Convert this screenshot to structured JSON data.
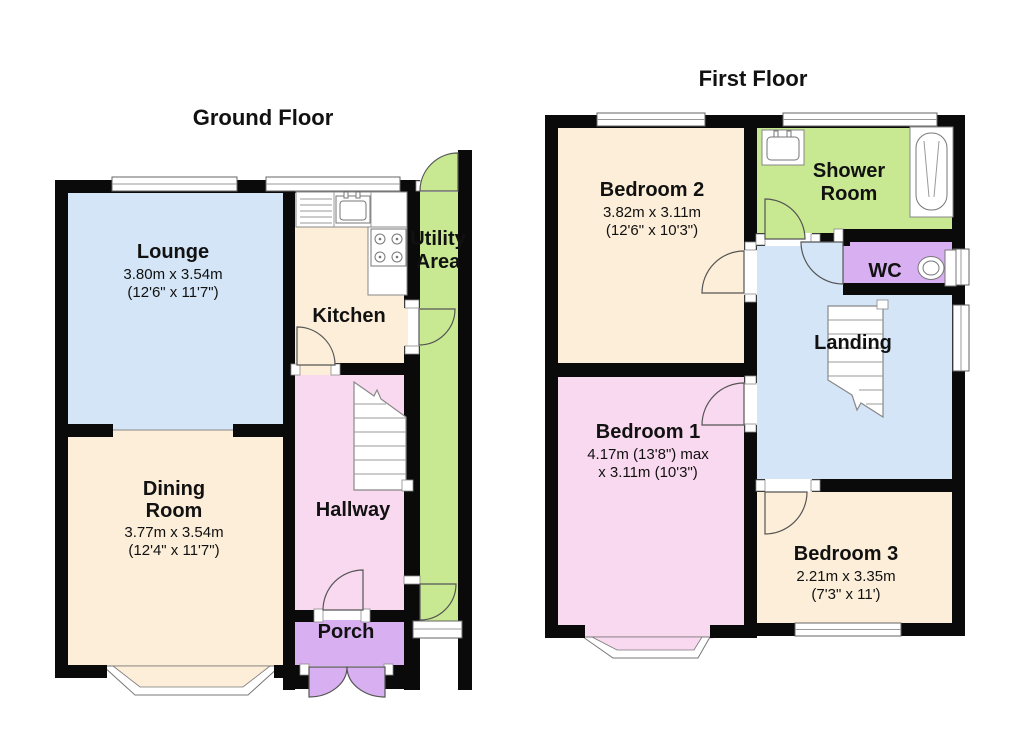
{
  "palette": {
    "wall": "#0a0a0a",
    "blue": "#d3e5f6",
    "cream": "#fceed8",
    "pink": "#f9d9ef",
    "purple": "#d8aff0",
    "green": "#c8e891",
    "outline": "#555555"
  },
  "ground_floor": {
    "title": "Ground Floor",
    "lounge": {
      "name": "Lounge",
      "metric": "3.80m x 3.54m",
      "imperial": "(12'6\" x 11'7\")"
    },
    "dining": {
      "name1": "Dining",
      "name2": "Room",
      "metric": "3.77m x 3.54m",
      "imperial": "(12'4\" x 11'7\")"
    },
    "kitchen": {
      "name": "Kitchen"
    },
    "hallway": {
      "name": "Hallway"
    },
    "porch": {
      "name": "Porch"
    },
    "utility": {
      "name1": "Utility",
      "name2": "Area"
    }
  },
  "first_floor": {
    "title": "First Floor",
    "bedroom2": {
      "name": "Bedroom 2",
      "metric": "3.82m x 3.11m",
      "imperial": "(12'6\" x 10'3\")"
    },
    "shower": {
      "name1": "Shower",
      "name2": "Room"
    },
    "wc": {
      "name": "WC"
    },
    "landing": {
      "name": "Landing"
    },
    "bedroom1": {
      "name": "Bedroom 1",
      "metric": "4.17m (13'8\") max",
      "imperial": "x 3.11m (10'3\")"
    },
    "bedroom3": {
      "name": "Bedroom 3",
      "metric": "2.21m x 3.35m",
      "imperial": "(7'3\" x 11')"
    }
  }
}
